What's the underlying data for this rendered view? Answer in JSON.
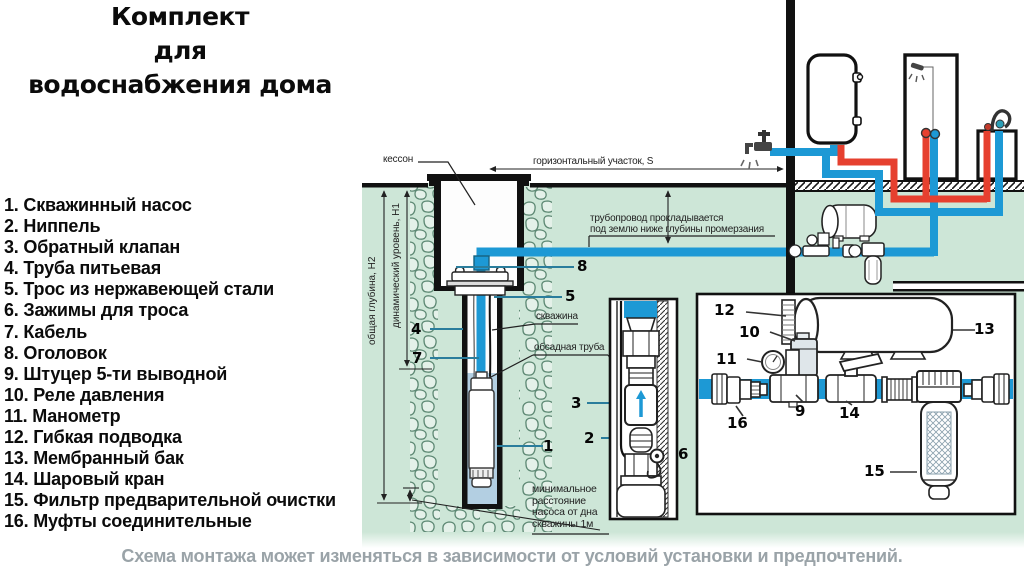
{
  "title": {
    "line1": "Комплект",
    "line2": "для",
    "line3": "водоснабжения дома"
  },
  "parts_list": [
    "1. Скважинный насос",
    "2. Ниппель",
    "3. Обратный клапан",
    "4. Труба питьевая",
    "5. Трос из нержавеющей стали",
    "6. Зажимы для троса",
    "7. Кабель",
    "8. Оголовок",
    "9. Штуцер 5-ти выводной",
    "10. Реле давления",
    "11. Манометр",
    "12. Гибкая подводка",
    "13. Мембранный бак",
    "14. Шаровый кран",
    "15. Фильтр предварительной очистки",
    "16. Муфты соединительные"
  ],
  "diagram": {
    "labels": {
      "caisson": "кессон",
      "horizontal_section": "горизонтальный участок,  S",
      "pipeline_note_line1": "трубопровод  прокладывается",
      "pipeline_note_line2": "под  землю  ниже  глубины  промерзания",
      "borehole": "скважина",
      "casing_pipe": "обсадная  труба",
      "min_distance_line1": "минимальное",
      "min_distance_line2": "расстояние",
      "min_distance_line3": "насоса  от  дна",
      "min_distance_line4": "скважины  1м",
      "total_depth": "общая глубина, Н2",
      "dynamic_level": "динамический уровень, Н1"
    },
    "markers": {
      "m1": "1",
      "m2": "2",
      "m3": "3",
      "m4": "4",
      "m5": "5",
      "m6": "6",
      "m7": "7",
      "m8": "8",
      "m9": "9",
      "m10": "10",
      "m11": "11",
      "m12": "12",
      "m13": "13",
      "m14": "14",
      "m15": "15",
      "m16": "16"
    },
    "colors": {
      "ground_green": "#cde6d7",
      "pipe_blue": "#1d99d5",
      "pipe_red": "#e6402f",
      "leader_teal": "#2a7d9c",
      "well_water": "#b3cfe2",
      "caption_gray": "#9aa3a8"
    }
  },
  "footer": {
    "note": "Схема монтажа может изменяться в зависимости от условий установки и предпочтений."
  }
}
